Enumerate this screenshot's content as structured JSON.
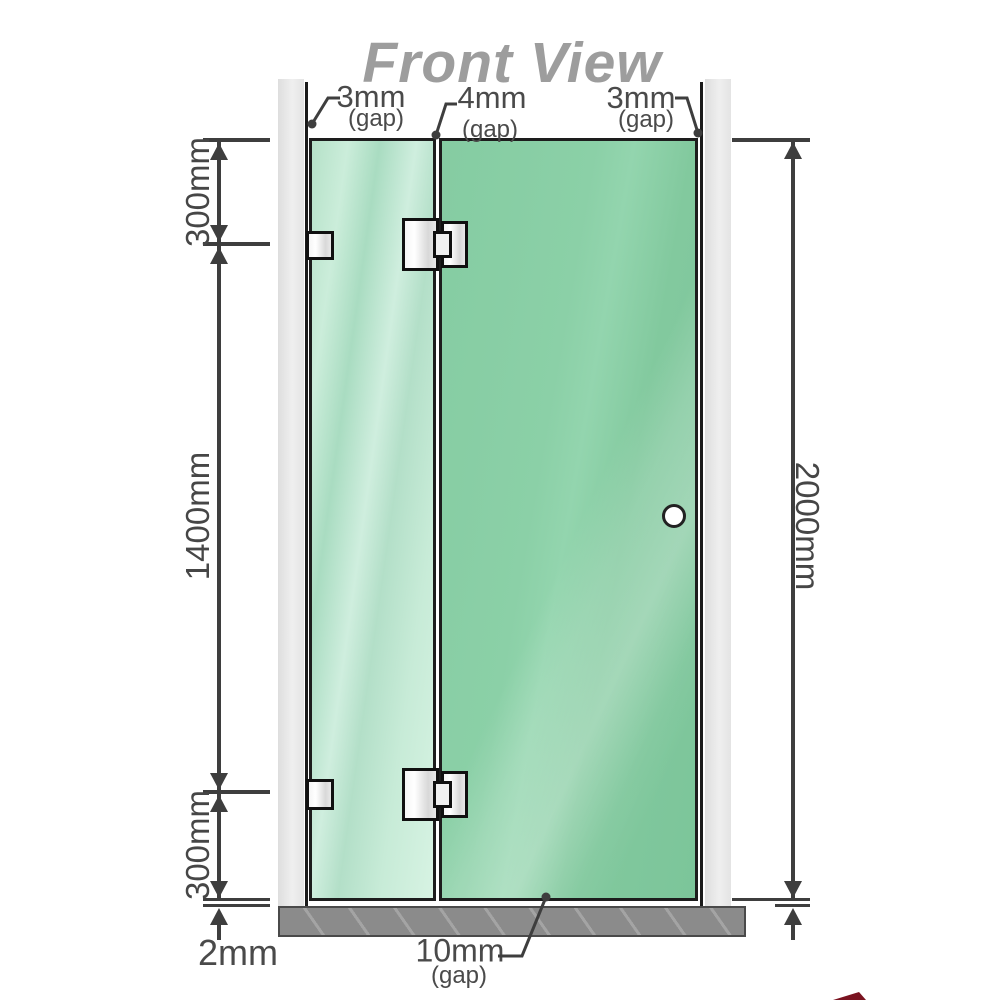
{
  "title": "Front View",
  "gaps": {
    "top_left": {
      "value": "3mm",
      "label": "(gap)"
    },
    "top_center": {
      "value": "4mm",
      "label": "(gap)"
    },
    "top_right": {
      "value": "3mm",
      "label": "(gap)"
    },
    "bottom": {
      "value": "10mm",
      "label": "(gap)"
    }
  },
  "heights": {
    "upper_segment": "300mm",
    "middle_segment": "1400mm",
    "lower_segment": "300mm",
    "total": "2000mm",
    "floor_clearance": "2mm"
  },
  "colors": {
    "title_gray": "#9d9d9d",
    "dimension_line": "#3e3e3e",
    "glass_fixed_panel": "#c9ecda",
    "glass_door_panel": "#85cca2",
    "wall": "#e8e8e8",
    "floor": "#8b8b8b",
    "metal_hardware": "#e9e9e9",
    "corner_mark_red": "#7a1320"
  },
  "icons": {
    "handle": "door-knob-circle",
    "hinges": "glass-door-hinge",
    "brackets": "wall-glass-clamp"
  }
}
